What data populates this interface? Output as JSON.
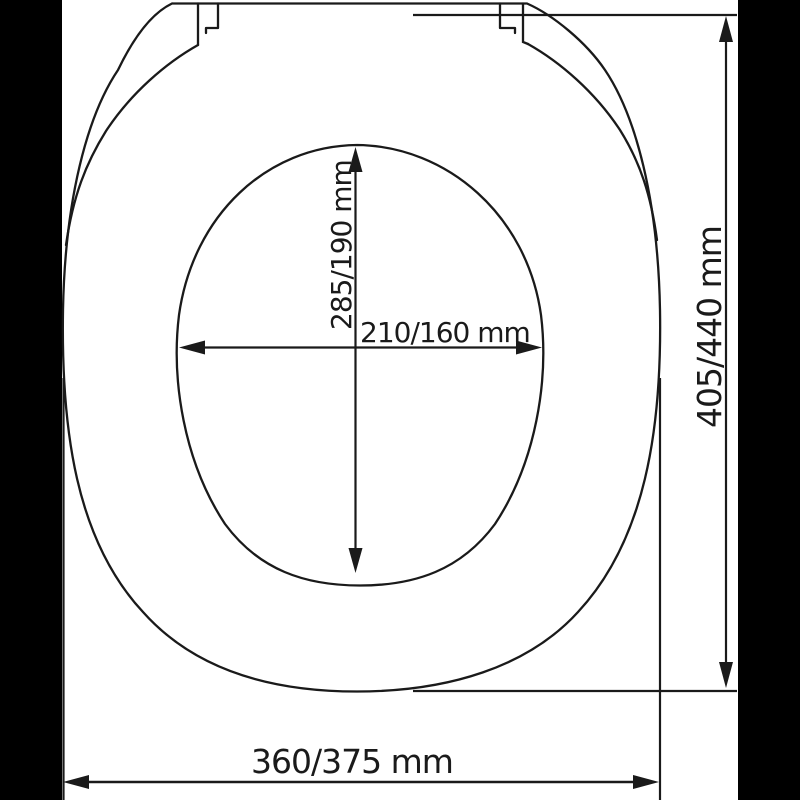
{
  "colors": {
    "letterbox": "#000000",
    "canvas": "#ffffff",
    "line": "#1a1a1a"
  },
  "diagram": {
    "type": "technical-dimension-drawing",
    "subject": "toilet-seat-top-view",
    "labels": {
      "inner_length": "285/190 mm",
      "inner_width": "210/160 mm",
      "outer_length": "405/440 mm",
      "outer_width": "360/375 mm"
    }
  }
}
